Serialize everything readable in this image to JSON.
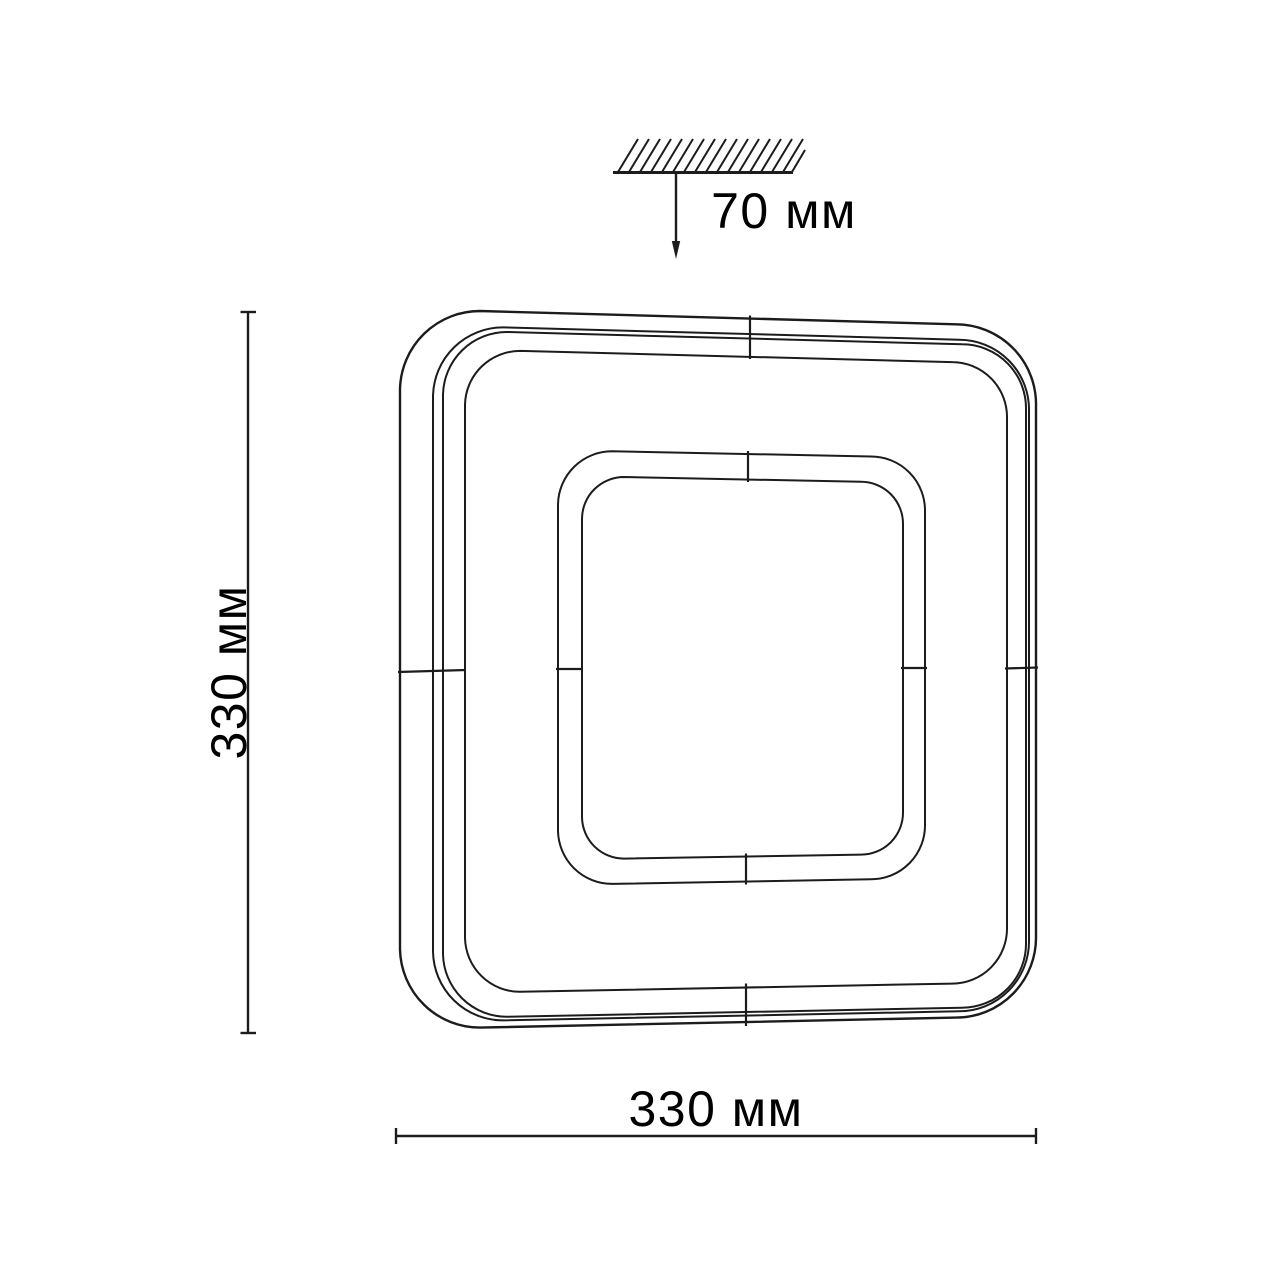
{
  "drawing": {
    "type": "ceiling-light-fixture-dimension-drawing",
    "dimensions": {
      "height_label": "330 мм",
      "width_label": "330 мм",
      "depth_label": "70 мм"
    },
    "colors": {
      "line": "#1c1c1c",
      "text": "#000000",
      "background": "#ffffff"
    },
    "icons": [
      "ceiling-surface-hatch-icon",
      "down-arrow-icon"
    ]
  }
}
